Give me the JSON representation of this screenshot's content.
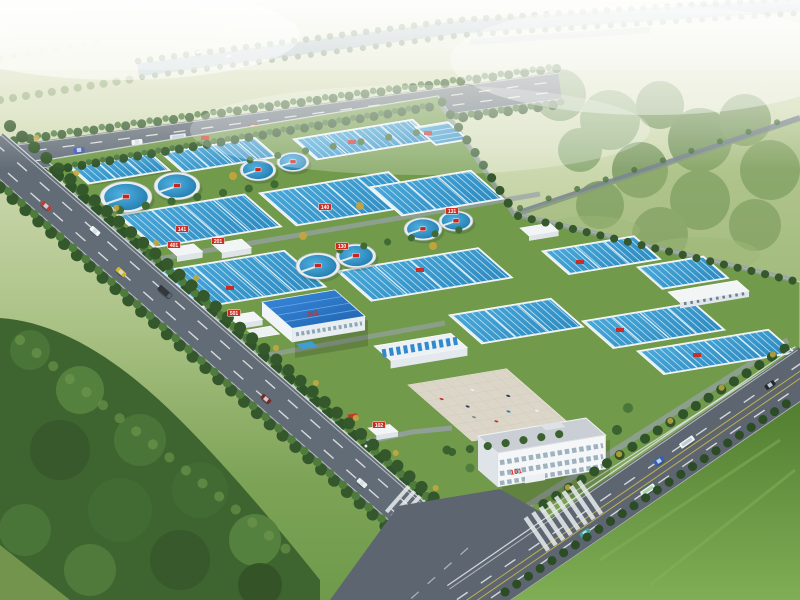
{
  "scene": {
    "description": "Aerial architectural rendering of a water / sewage treatment plant campus seen from a high oblique angle in hazy light",
    "style": "photorealistic bird's-eye CG rendering",
    "environment": "green countryside with dense woodland to the south-west, open meadows to the north-east, a tree-lined river on the hazy horizon, tree-lined arterial roads and a zebra-striped intersection at the lower right"
  },
  "plant": {
    "unit_labels": {
      "admin_building": "101",
      "gatehouse": "102",
      "blue_workshop": "301",
      "utility_buildings": [
        "401",
        "201",
        "501"
      ],
      "basin_tags": [
        "140",
        "141",
        "130",
        "131"
      ]
    },
    "counts": {
      "circular_clarifiers": 8,
      "rectangular_basin_clusters": 14,
      "roads": 4,
      "vehicles_visible": 15
    }
  },
  "palette": {
    "haze": "#edf0de",
    "field_green": "#8fae67",
    "forest_green": "#3e642f",
    "plant_grass": "#6d9647",
    "pool_water": "#3e9ed2",
    "pool_lane": "#c9e8f6",
    "clarifier_water": "#2f96cc",
    "tank_rim": "#e9edef",
    "road_gray": "#626c76",
    "river_blue_gray": "#93aab8",
    "roof_blue": "#2b7fd4",
    "building_white": "#f4f6f7",
    "plaza_tan": "#dbd6c8",
    "label_red": "#d0281e"
  }
}
